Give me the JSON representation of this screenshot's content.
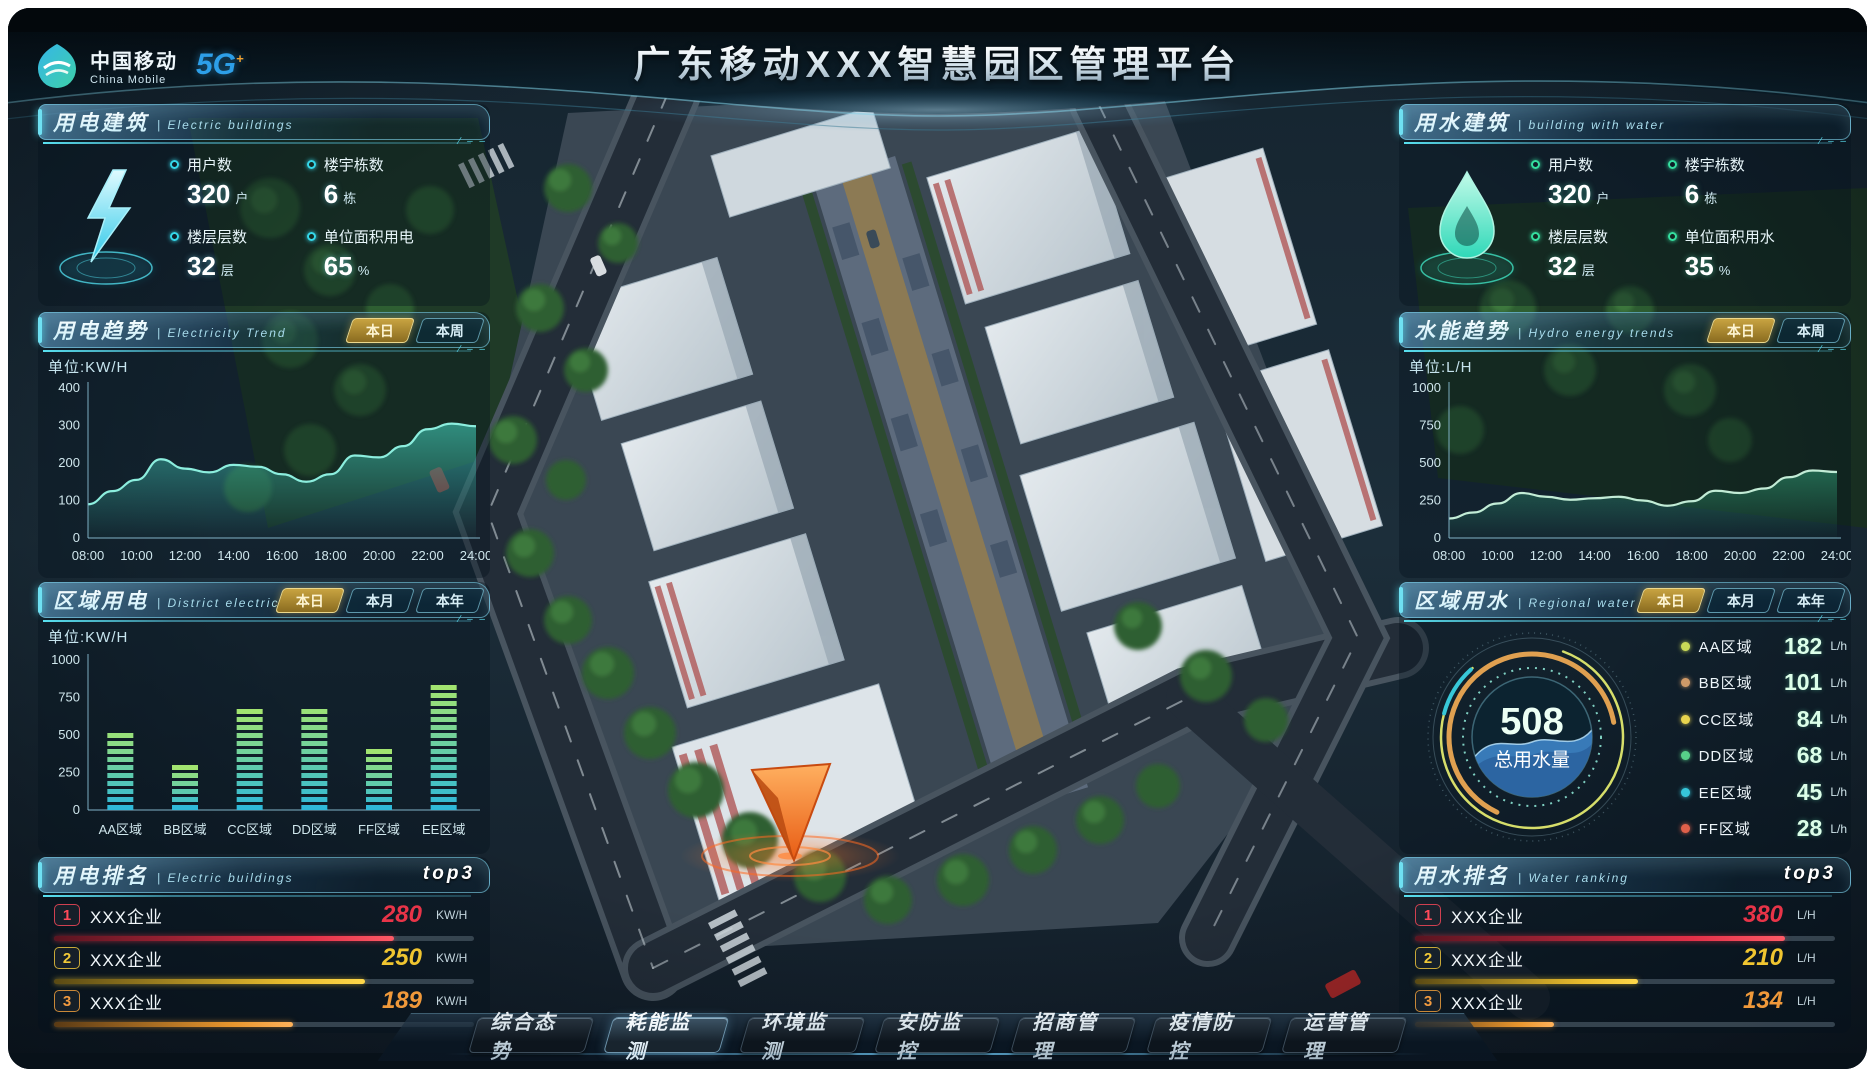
{
  "header": {
    "title": "广东移动XXX智慧园区管理平台",
    "logo": {
      "name_cn": "中国移动",
      "name_en": "China Mobile",
      "badge_5g": "5G",
      "badge_plus": "+"
    }
  },
  "nav": {
    "active": "耗能监测",
    "items": [
      "综合态势",
      "耗能监测",
      "环境监测",
      "安防监控",
      "招商管理",
      "疫情防控",
      "运营管理"
    ]
  },
  "panels": {
    "electric_building": {
      "title": "用电建筑",
      "subtitle": "| Electric buildings",
      "stats": [
        {
          "label": "用户数",
          "value": "320",
          "unit": "户"
        },
        {
          "label": "楼宇栋数",
          "value": "6",
          "unit": "栋"
        },
        {
          "label": "楼层层数",
          "value": "32",
          "unit": "层"
        },
        {
          "label": "单位面积用电",
          "value": "65",
          "unit": "%"
        }
      ]
    },
    "electricity_trend": {
      "title": "用电趋势",
      "subtitle": "| Electricity Trend",
      "tabs": [
        "本日",
        "本周"
      ],
      "active_tab": "本日",
      "unit_label": "单位:KW/H"
    },
    "district_electricity": {
      "title": "区域用电",
      "subtitle": "| District electricity",
      "tabs": [
        "本日",
        "本月",
        "本年"
      ],
      "active_tab": "本日",
      "unit_label": "单位:KW/H"
    },
    "electric_ranking": {
      "title": "用电排名",
      "subtitle": "| Electric buildings",
      "badge": "top3",
      "unit": "KW/H",
      "rows": [
        {
          "rank": "1",
          "name": "XXX企业",
          "value": "280",
          "bar_pct": 81
        },
        {
          "rank": "2",
          "name": "XXX企业",
          "value": "250",
          "bar_pct": 74
        },
        {
          "rank": "3",
          "name": "XXX企业",
          "value": "189",
          "bar_pct": 57
        }
      ]
    },
    "water_building": {
      "title": "用水建筑",
      "subtitle": "| building with water",
      "stats": [
        {
          "label": "用户数",
          "value": "320",
          "unit": "户"
        },
        {
          "label": "楼宇栋数",
          "value": "6",
          "unit": "栋"
        },
        {
          "label": "楼层层数",
          "value": "32",
          "unit": "层"
        },
        {
          "label": "单位面积用水",
          "value": "35",
          "unit": "%"
        }
      ]
    },
    "hydro_trend": {
      "title": "水能趋势",
      "subtitle": "| Hydro energy trends",
      "tabs": [
        "本日",
        "本周"
      ],
      "active_tab": "本日",
      "unit_label": "单位:L/H"
    },
    "regional_water": {
      "title": "区域用水",
      "subtitle": "| Regional water",
      "tabs": [
        "本日",
        "本月",
        "本年"
      ],
      "active_tab": "本日",
      "gauge_value": "508",
      "gauge_label": "总用水量",
      "legend_unit": "L/h",
      "legend": [
        {
          "name": "AA区域",
          "value": "182",
          "color": "#c9d957"
        },
        {
          "name": "BB区域",
          "value": "101",
          "color": "#cf9a68"
        },
        {
          "name": "CC区域",
          "value": "84",
          "color": "#e8d44e"
        },
        {
          "name": "DD区域",
          "value": "68",
          "color": "#57d089"
        },
        {
          "name": "EE区域",
          "value": "45",
          "color": "#36c6d9"
        },
        {
          "name": "FF区域",
          "value": "28",
          "color": "#e0604a"
        }
      ]
    },
    "water_ranking": {
      "title": "用水排名",
      "subtitle": "| Water ranking",
      "badge": "top3",
      "unit": "L/H",
      "rows": [
        {
          "rank": "1",
          "name": "XXX企业",
          "value": "380",
          "bar_pct": 88
        },
        {
          "rank": "2",
          "name": "XXX企业",
          "value": "210",
          "bar_pct": 53
        },
        {
          "rank": "3",
          "name": "XXX企业",
          "value": "134",
          "bar_pct": 33
        }
      ]
    }
  },
  "chart_data": [
    {
      "id": "electricity_trend",
      "type": "area",
      "title": "用电趋势 Electricity Trend",
      "ylabel": "KW/H",
      "ylim": [
        0,
        400
      ],
      "yticks": [
        0,
        100,
        200,
        300,
        400
      ],
      "x_ticks": [
        "08:00",
        "10:00",
        "12:00",
        "14:00",
        "16:00",
        "18:00",
        "20:00",
        "22:00",
        "24:00"
      ],
      "values": [
        90,
        125,
        155,
        210,
        185,
        175,
        195,
        190,
        170,
        150,
        170,
        220,
        215,
        245,
        290,
        305,
        298
      ],
      "line_color": "#8ceede",
      "fill_color": "#46dcc8"
    },
    {
      "id": "hydro_trend",
      "type": "area",
      "title": "水能趋势 Hydro energy trends",
      "ylabel": "L/H",
      "ylim": [
        0,
        1000
      ],
      "yticks": [
        0,
        250,
        500,
        750,
        1000
      ],
      "x_ticks": [
        "08:00",
        "10:00",
        "12:00",
        "14:00",
        "16:00",
        "18:00",
        "20:00",
        "22:00",
        "24:00"
      ],
      "values": [
        130,
        170,
        230,
        300,
        275,
        255,
        265,
        275,
        250,
        215,
        245,
        315,
        300,
        330,
        405,
        450,
        440
      ],
      "line_color": "#c2ecd6",
      "fill_color": "#2f9a74"
    },
    {
      "id": "district_electricity",
      "type": "bar",
      "title": "区域用电 District electricity",
      "ylabel": "KW/H",
      "categories": [
        "AA区域",
        "BB区域",
        "CC区域",
        "DD区域",
        "FF区域",
        "EE区域"
      ],
      "values": [
        560,
        300,
        680,
        710,
        420,
        850
      ],
      "ylim": [
        0,
        1000
      ],
      "yticks": [
        0,
        250,
        500,
        750,
        1000
      ],
      "bar_color_bottom": "#2fb8d8",
      "bar_color_top": "#a2e470"
    },
    {
      "id": "regional_water",
      "type": "pie",
      "title": "区域用水 Regional water 总用水量",
      "total": 508,
      "unit": "L/h",
      "categories": [
        "AA区域",
        "BB区域",
        "CC区域",
        "DD区域",
        "EE区域",
        "FF区域"
      ],
      "values": [
        182,
        101,
        84,
        68,
        45,
        28
      ]
    },
    {
      "id": "electric_ranking",
      "type": "table",
      "title": "用电排名 top3",
      "unit": "KW/H",
      "rows": [
        [
          "1",
          "XXX企业",
          280
        ],
        [
          "2",
          "XXX企业",
          250
        ],
        [
          "3",
          "XXX企业",
          189
        ]
      ]
    },
    {
      "id": "water_ranking",
      "type": "table",
      "title": "用水排名 top3",
      "unit": "L/H",
      "rows": [
        [
          "1",
          "XXX企业",
          380
        ],
        [
          "2",
          "XXX企业",
          210
        ],
        [
          "3",
          "XXX企业",
          134
        ]
      ]
    }
  ]
}
